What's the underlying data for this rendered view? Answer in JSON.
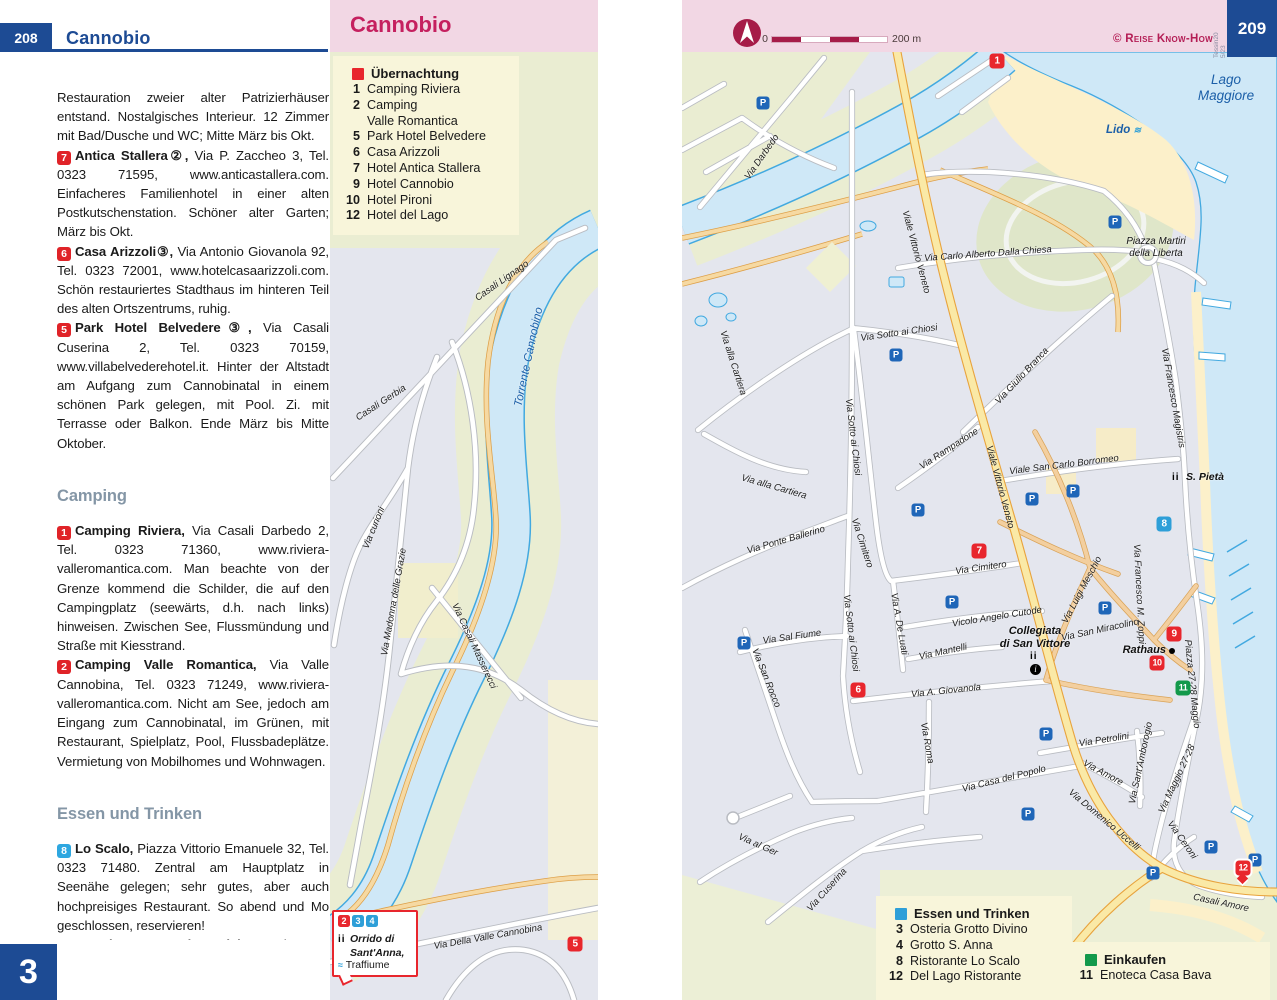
{
  "header_left": {
    "page_number": "208",
    "title": "Cannobio"
  },
  "chapter_tab": "3",
  "map_panel": {
    "title": "Cannobio"
  },
  "header_right": {
    "credit": "© Reise Know-How",
    "edition": "Tessin20\n5/23",
    "page_number": "209",
    "scale_zero": "0",
    "scale_label": "200 m"
  },
  "text_column": {
    "paragraphs": [
      {
        "type": "plain",
        "text": "Restauration zweier alter Patrizierhäuser entstand. Nostalgisches Interieur. 12 Zimmer mit Bad/Dusche und WC; Mitte März bis Okt."
      },
      {
        "type": "entry",
        "badge": "7",
        "badge_color": "red",
        "name": "Antica Stallera②,",
        "text": "Via P. Zaccheo 3, Tel. 0323 71595, www.anticastallera.com. Einfacheres Familienhotel in einer alten Postkutschenstation. Schöner alter Garten; März bis Okt."
      },
      {
        "type": "entry",
        "badge": "6",
        "badge_color": "red",
        "name": "Casa Arizzoli③,",
        "text": "Via Antonio Giovanola 92, Tel. 0323 72001, www.hotelcasaarizzoli.com. Schön restauriertes Stadthaus im hinteren Teil des alten Ortszentrums, ruhig."
      },
      {
        "type": "entry",
        "badge": "5",
        "badge_color": "red",
        "name": "Park Hotel Belvedere③,",
        "text": "Via Casali Cuserina 2, Tel. 0323 70159, www.villabelvederehotel.it. Hinter der Altstadt am Aufgang zum Cannobinatal in einem schönen Park gelegen, mit Pool. Zi. mit Terrasse oder Balkon. Ende März bis Mitte Oktober."
      },
      {
        "type": "heading",
        "text": "Camping"
      },
      {
        "type": "entry",
        "badge": "1",
        "badge_color": "red",
        "name": "Camping Riviera,",
        "text": "Via Casali Darbedo 2, Tel. 0323 71360, www.riviera-valleromantica.com. Man beachte von der Grenze kommend die Schilder, die auf den Campingplatz (seewärts, d.h. nach links) hinweisen. Zwischen See, Flussmündung und Straße mit Kiesstrand."
      },
      {
        "type": "entry",
        "badge": "2",
        "badge_color": "red",
        "name": "Camping Valle Romantica,",
        "text": "Via Valle Cannobina, Tel. 0323 71249, www.riviera-valleromantica.com. Nicht am See, jedoch am Eingang zum Cannobinatal, im Grünen, mit Restaurant, Spielplatz, Pool, Flussbadeplätze. Vermietung von Mobilhomes und Wohnwagen."
      },
      {
        "type": "heading",
        "text": "Essen und Trinken"
      },
      {
        "type": "entry",
        "badge": "8",
        "badge_color": "blue",
        "name": "Lo Scalo,",
        "text": "Piazza Vittorio Emanuele 32, Tel. 0323 71480. Zentral am Hauptplatz in Seenähe gelegen; sehr gutes, aber auch hochpreisiges Restaurant. So abend und Mo geschlossen, reservieren!"
      },
      {
        "type": "entry",
        "badge": "3",
        "badge_color": "blue",
        "name": "Osteria Grotto Vino Divino,",
        "text": "Tel. 0323 3438 18. Schöne alte Osteria mit typischer Küche. Im Sommer lauschiges Gartenrestaurant mit Stein-"
      }
    ]
  },
  "legend_accommodation": {
    "title": "Übernachtung",
    "color": "#e8262d",
    "items": [
      {
        "num": "1",
        "label": "Camping Riviera"
      },
      {
        "num": "2",
        "label": "Camping\nValle Romantica"
      },
      {
        "num": "5",
        "label": "Park Hotel Belvedere"
      },
      {
        "num": "6",
        "label": "Casa Arizzoli"
      },
      {
        "num": "7",
        "label": "Hotel Antica Stallera"
      },
      {
        "num": "9",
        "label": "Hotel Cannobio"
      },
      {
        "num": "10",
        "label": "Hotel Pironi"
      },
      {
        "num": "12",
        "label": "Hotel del Lago"
      }
    ]
  },
  "legend_food": {
    "title": "Essen und Trinken",
    "color": "#2e9fd8",
    "items": [
      {
        "num": "3",
        "label": "Osteria Grotto Divino"
      },
      {
        "num": "4",
        "label": "Grotto S. Anna"
      },
      {
        "num": "8",
        "label": "Ristorante Lo Scalo"
      },
      {
        "num": "12",
        "label": "Del Lago Ristorante"
      }
    ]
  },
  "legend_shopping": {
    "title": "Einkaufen",
    "color": "#13994b",
    "items": [
      {
        "num": "11",
        "label": "Enoteca Casa Bava"
      }
    ]
  },
  "callout": {
    "badges": [
      {
        "num": "2",
        "color": "red"
      },
      {
        "num": "3",
        "color": "blue"
      },
      {
        "num": "4",
        "color": "blue"
      }
    ],
    "line1": "Orrido di",
    "line2": "Sant'Anna,",
    "line3": "Traffiume"
  },
  "water_labels": {
    "lago_line1": "Lago",
    "lago_line2": "Maggiore",
    "lido": "Lido"
  },
  "pois": {
    "piazza_line1": "Piazza Martiri",
    "piazza_line2": "della Liberta",
    "collegiata_line1": "Collegiata",
    "collegiata_line2": "di San Vittore",
    "rathaus": "Rathaus",
    "s_pieta": "S. Pietà"
  },
  "street_labels": [
    {
      "t": "Torrente Cannobino",
      "x": 529,
      "y": 357,
      "r": -78,
      "k": "water"
    },
    {
      "t": "Casali Lignago",
      "x": 502,
      "y": 281,
      "r": -35
    },
    {
      "t": "Casali Gerbia",
      "x": 381,
      "y": 403,
      "r": -33
    },
    {
      "t": "Via curioni",
      "x": 374,
      "y": 528,
      "r": -68
    },
    {
      "t": "Via Madonna delle Grazie",
      "x": 394,
      "y": 602,
      "r": -80
    },
    {
      "t": "Via Casali Masserecci",
      "x": 474,
      "y": 646,
      "r": 65
    },
    {
      "t": "Via Della Valle Cannobina",
      "x": 488,
      "y": 937,
      "r": -10
    },
    {
      "t": "Via Darbedo",
      "x": 762,
      "y": 157,
      "r": -55
    },
    {
      "t": "Viale Vittorio Veneto",
      "x": 916,
      "y": 252,
      "r": 75
    },
    {
      "t": "Viale Vittorio Veneto",
      "x": 1000,
      "y": 487,
      "r": 75
    },
    {
      "t": "Via Carlo Alberto Dalla Chiesa",
      "x": 988,
      "y": 254,
      "r": -4
    },
    {
      "t": "Via alla Cartiera",
      "x": 733,
      "y": 363,
      "r": 72
    },
    {
      "t": "Via alla Cartiera",
      "x": 774,
      "y": 487,
      "r": 16
    },
    {
      "t": "Via Sotto ai Chiosi",
      "x": 899,
      "y": 333,
      "r": -8
    },
    {
      "t": "Via Sotto ai Chiosi",
      "x": 853,
      "y": 437,
      "r": 83
    },
    {
      "t": "Via Sotto ai Chiosi",
      "x": 851,
      "y": 633,
      "r": 83
    },
    {
      "t": "Via Rampadone",
      "x": 949,
      "y": 449,
      "r": -33
    },
    {
      "t": "Viale San Carlo Borromeo",
      "x": 1064,
      "y": 465,
      "r": -7
    },
    {
      "t": "Via Giulio Branca",
      "x": 1022,
      "y": 376,
      "r": -47
    },
    {
      "t": "Via Francesco Magistris",
      "x": 1173,
      "y": 398,
      "r": 80
    },
    {
      "t": "Via Ponte Ballerino",
      "x": 786,
      "y": 540,
      "r": -16
    },
    {
      "t": "Via Cimitero",
      "x": 862,
      "y": 543,
      "r": 72
    },
    {
      "t": "Via Cimitero",
      "x": 981,
      "y": 568,
      "r": -8
    },
    {
      "t": "Via A. De Luati",
      "x": 899,
      "y": 624,
      "r": 80
    },
    {
      "t": "Via Sal Fiume",
      "x": 792,
      "y": 637,
      "r": -8
    },
    {
      "t": "Via San Rocco",
      "x": 766,
      "y": 678,
      "r": 68
    },
    {
      "t": "Vicolo Angelo Cutode",
      "x": 997,
      "y": 617,
      "r": -9
    },
    {
      "t": "Via Luigi Meschio",
      "x": 1082,
      "y": 590,
      "r": -62
    },
    {
      "t": "Via San Miracolino",
      "x": 1100,
      "y": 630,
      "r": -12
    },
    {
      "t": "Via Francesco M. Zoppi",
      "x": 1139,
      "y": 594,
      "r": 87
    },
    {
      "t": "Via Mantelli",
      "x": 943,
      "y": 652,
      "r": -12
    },
    {
      "t": "Via A. Giovanola",
      "x": 946,
      "y": 691,
      "r": -6
    },
    {
      "t": "Via Roma",
      "x": 927,
      "y": 743,
      "r": 80
    },
    {
      "t": "Via Casa del Popolo",
      "x": 1004,
      "y": 779,
      "r": -14
    },
    {
      "t": "Via Petrolini",
      "x": 1104,
      "y": 740,
      "r": -9
    },
    {
      "t": "Via Amore",
      "x": 1103,
      "y": 773,
      "r": 28
    },
    {
      "t": "Via Sant'Amborogio",
      "x": 1141,
      "y": 763,
      "r": -78
    },
    {
      "t": "Via Domenico Uccelli",
      "x": 1104,
      "y": 820,
      "r": 40
    },
    {
      "t": "Via Maggio 27-28",
      "x": 1177,
      "y": 779,
      "r": -65
    },
    {
      "t": "Piazza 27-28 Maggio",
      "x": 1192,
      "y": 684,
      "r": 84
    },
    {
      "t": "Via Ceroni",
      "x": 1182,
      "y": 840,
      "r": 55
    },
    {
      "t": "Casali Amore",
      "x": 1221,
      "y": 903,
      "r": 12
    },
    {
      "t": "Via al Ger",
      "x": 758,
      "y": 845,
      "r": 24
    },
    {
      "t": "Via Cuserina",
      "x": 827,
      "y": 890,
      "r": -48
    }
  ],
  "markers": [
    {
      "n": "1",
      "c": "red",
      "x": 997,
      "y": 61
    },
    {
      "n": "5",
      "c": "red",
      "x": 575,
      "y": 944
    },
    {
      "n": "6",
      "c": "red",
      "x": 858,
      "y": 690
    },
    {
      "n": "7",
      "c": "red",
      "x": 979,
      "y": 551
    },
    {
      "n": "8",
      "c": "blue",
      "x": 1164,
      "y": 524
    },
    {
      "n": "9",
      "c": "red",
      "x": 1174,
      "y": 634
    },
    {
      "n": "10",
      "c": "red",
      "x": 1157,
      "y": 663
    },
    {
      "n": "11",
      "c": "green",
      "x": 1183,
      "y": 688
    },
    {
      "n": "12",
      "c": "red",
      "x": 1243,
      "y": 868,
      "pointer": true
    }
  ],
  "parking_positions": [
    [
      763,
      103
    ],
    [
      1115,
      222
    ],
    [
      896,
      355
    ],
    [
      918,
      510
    ],
    [
      1032,
      499
    ],
    [
      1073,
      491
    ],
    [
      952,
      602
    ],
    [
      1105,
      608
    ],
    [
      744,
      643
    ],
    [
      1046,
      734
    ],
    [
      1028,
      814
    ],
    [
      1211,
      847
    ],
    [
      1153,
      873
    ],
    [
      1255,
      860
    ]
  ],
  "colors": {
    "accent_red": "#e8262d",
    "accent_blue": "#2e9fd8",
    "accent_green": "#13994b",
    "page_blue": "#1d4b94",
    "title_pink": "#c5205f",
    "scale_dark": "#a61c48"
  }
}
